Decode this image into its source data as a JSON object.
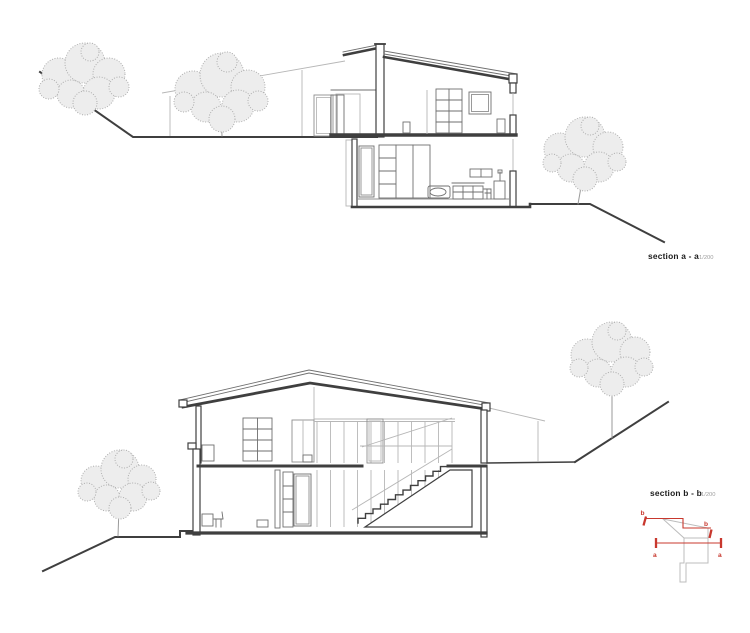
{
  "sections": {
    "a": {
      "label": "section a - a",
      "scale": "1/200"
    },
    "b": {
      "label": "section b - b",
      "scale": "1/200"
    }
  },
  "key_plan": {
    "label_b_start": "b",
    "label_b_end": "b",
    "label_a_start": "a",
    "label_a_end": "a"
  },
  "colors": {
    "background": "#ffffff",
    "cut_line": "#3f3f3f",
    "interior_line": "#6f6f6f",
    "elevation_line": "#b7b7b7",
    "foliage": "#aeaeae",
    "label_text": "#1a1a1a",
    "scale_text": "#9e9e9e",
    "accent_red": "#c8382e"
  }
}
